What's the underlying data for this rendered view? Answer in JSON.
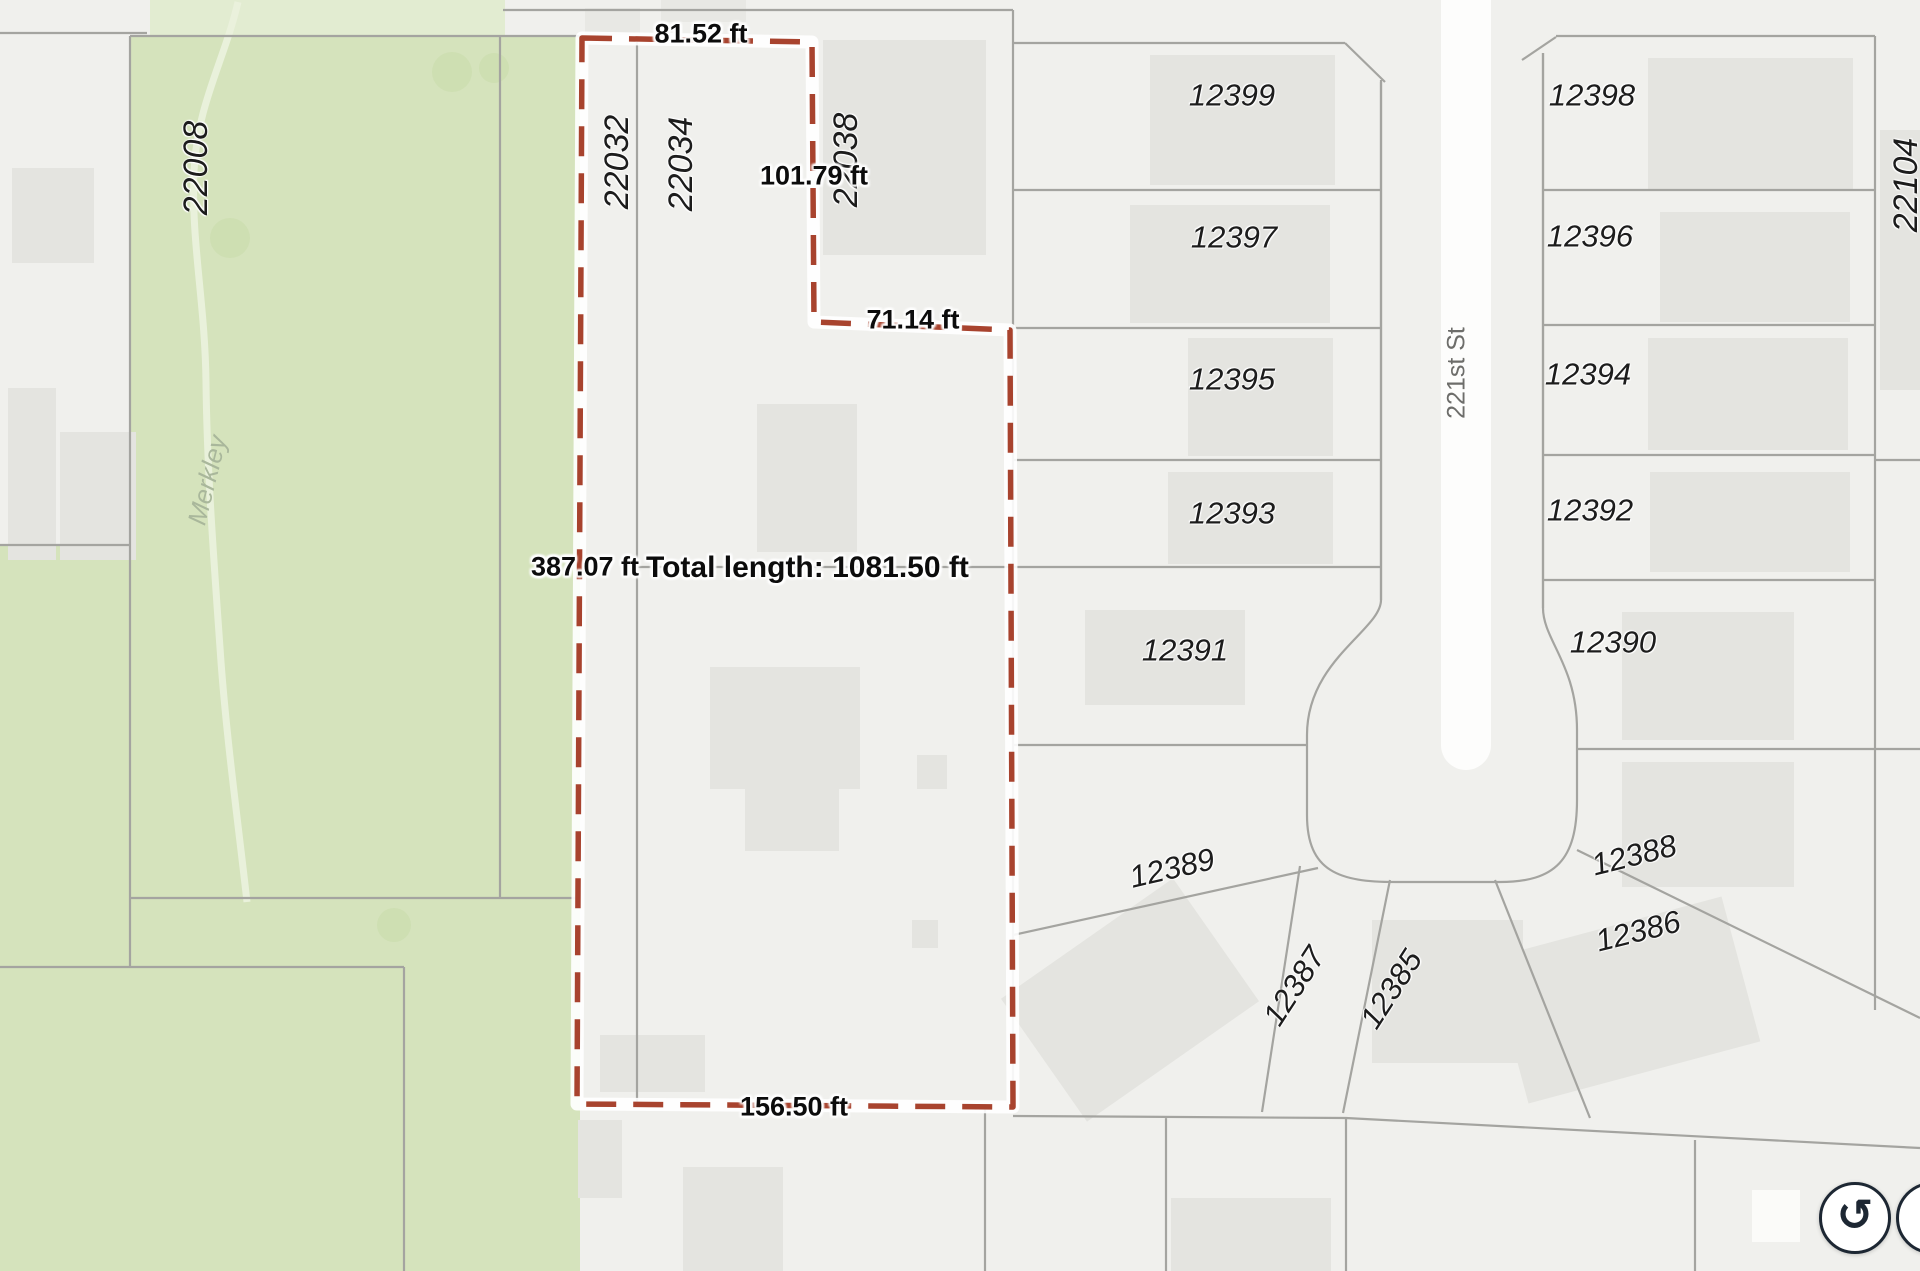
{
  "map_labels": {
    "parcels": {
      "p22008": "22008",
      "p22032": "22032",
      "p22034": "22034",
      "p22038": "22038",
      "p22104": "22104",
      "p12399": "12399",
      "p12397": "12397",
      "p12395": "12395",
      "p12393": "12393",
      "p12391": "12391",
      "p12389": "12389",
      "p12387": "12387",
      "p12385": "12385",
      "p12398": "12398",
      "p12396": "12396",
      "p12394": "12394",
      "p12392": "12392",
      "p12390": "12390",
      "p12388": "12388",
      "p12386": "12386"
    },
    "street_name": "221st St",
    "park_name": "Merkley"
  },
  "measurement": {
    "segments": {
      "top": "81.52 ft",
      "upper_right": "101.79 ft",
      "notch": "71.14 ft",
      "left": "387.07 ft",
      "right": "283.47 ft",
      "bottom": "156.50 ft"
    },
    "total": "Total length: 1081.50 ft"
  },
  "controls": {
    "reset_icon": "↺"
  },
  "colors": {
    "background": "#f0f0ed",
    "park": "#d5e3bc",
    "boundary": "#a4a4a0",
    "measure_red": "#a8432e",
    "road_white": "#fdfdfc"
  }
}
